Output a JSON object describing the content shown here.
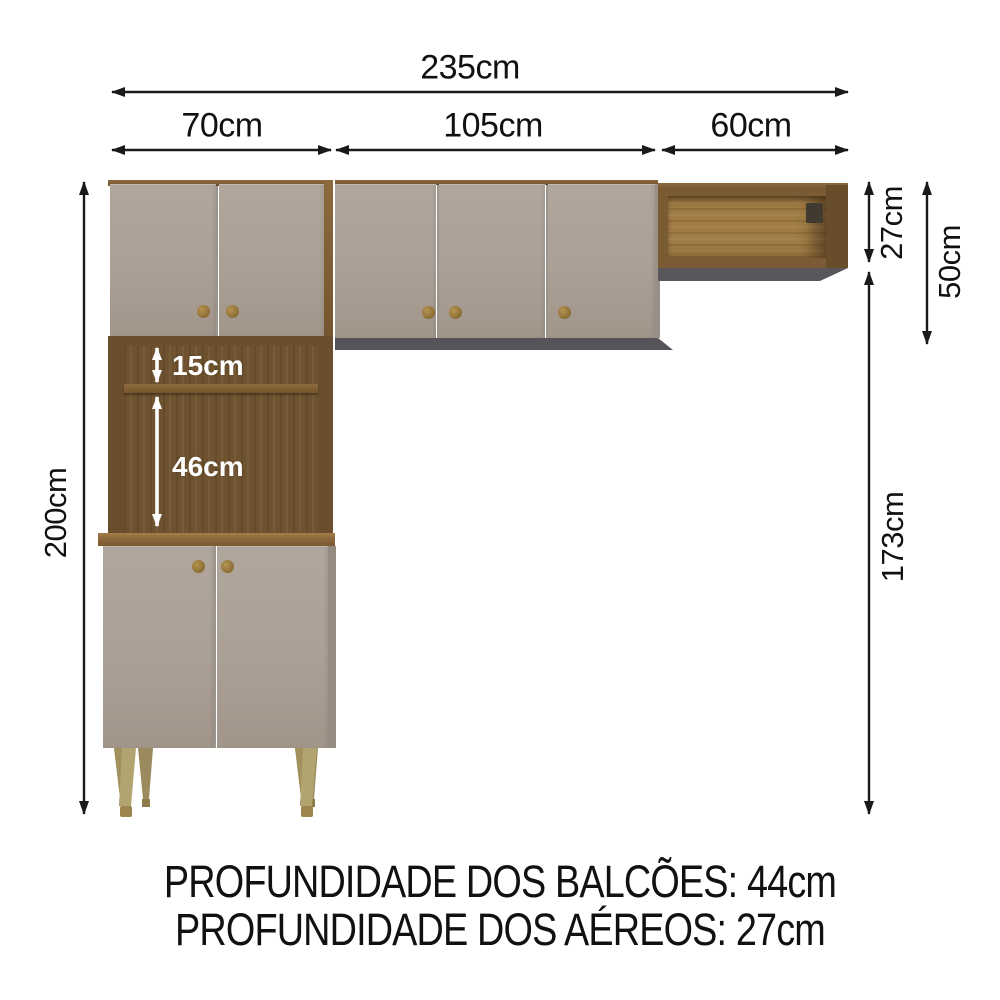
{
  "diagram": {
    "widths": {
      "total": "235cm",
      "left_section": "70cm",
      "middle_section": "105cm",
      "right_section": "60cm"
    },
    "heights": {
      "total": "200cm",
      "open_shelf": "27cm",
      "upper_right": "50cm",
      "lower_right": "173cm"
    },
    "niches": {
      "upper_niche": "15cm",
      "lower_niche": "46cm"
    },
    "footer": {
      "line1": "PROFUNDIDADE DOS BALCÕES: 44cm",
      "line2": "PROFUNDIDADE DOS AÉREOS: 27cm"
    },
    "colors": {
      "door": "#aba096",
      "wood_dark": "#6a4e2d",
      "wood_light": "#a17c45",
      "leg": "#b2a471",
      "shadow": "#56545a",
      "knob": "#9d8046",
      "dimension_line": "#1a1a1a"
    }
  }
}
